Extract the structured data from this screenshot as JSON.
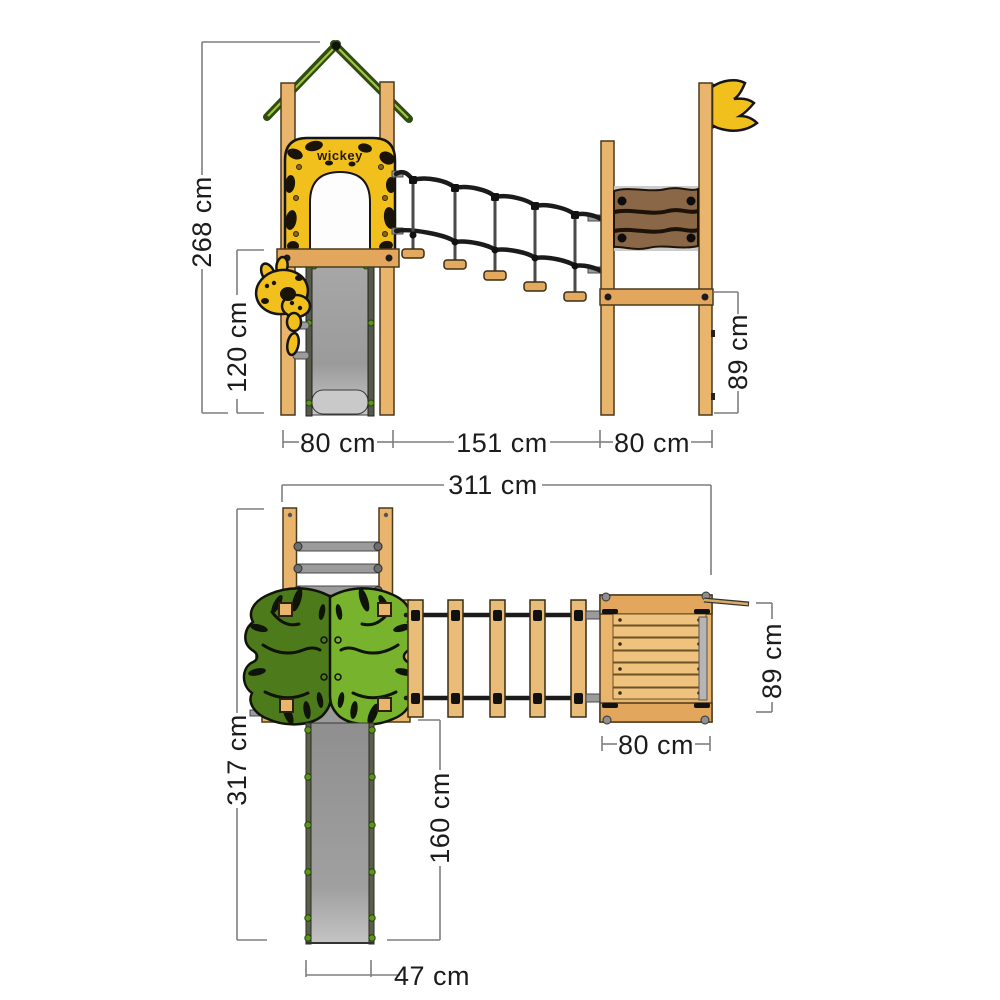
{
  "diagram": {
    "brand_logo": "wickey",
    "views": {
      "side_elevation": {
        "dimensions": {
          "total_height": "268 cm",
          "slide_platform_height": "120 cm",
          "left_tower_width": "80 cm",
          "bridge_span": "151 cm",
          "right_tower_width": "80 cm",
          "right_platform_height": "89 cm"
        }
      },
      "top_view": {
        "dimensions": {
          "total_length": "311 cm",
          "total_depth": "317 cm",
          "slide_length": "160 cm",
          "slide_width": "47 cm",
          "right_platform_width": "80 cm",
          "right_platform_depth": "89 cm"
        }
      }
    },
    "colors": {
      "wood": "#e9b46c",
      "accent_yellow": "#f2c01d",
      "leaf_dark": "#4d7a1a",
      "leaf_light": "#77b32c",
      "slide_gray": "#9e9e9e",
      "panel_brown": "#8a6747",
      "rope_black": "#1b1b1b",
      "dimension_gray": "#7f7f7f"
    }
  }
}
